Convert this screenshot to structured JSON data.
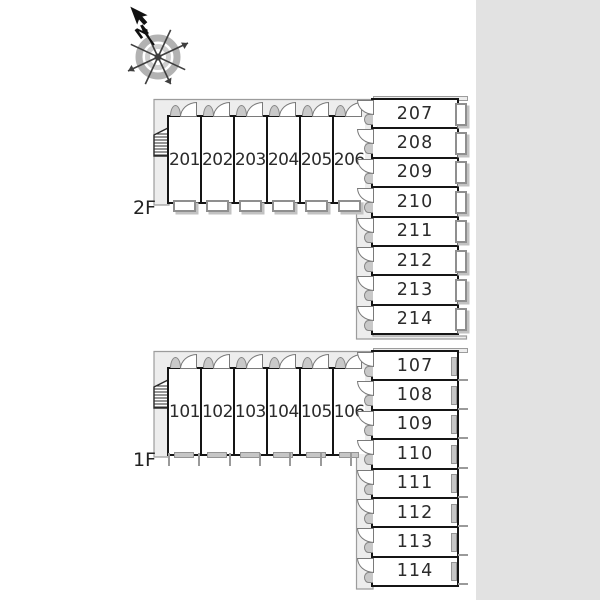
{
  "title": "apartment-unit-floor-plan",
  "compass": {
    "north_label": "N"
  },
  "floors": [
    {
      "label": "2F",
      "row_rooms": [
        "201",
        "202",
        "203",
        "204",
        "205",
        "206"
      ],
      "col_rooms": [
        "207",
        "208",
        "209",
        "210",
        "211",
        "212",
        "213",
        "214"
      ]
    },
    {
      "label": "1F",
      "row_rooms": [
        "101",
        "102",
        "103",
        "104",
        "105",
        "106"
      ],
      "col_rooms": [
        "107",
        "108",
        "109",
        "110",
        "111",
        "112",
        "113",
        "114"
      ]
    }
  ],
  "colors": {
    "wall": "#151515",
    "corridor_fill": "#ededed",
    "corridor_line": "#9c9c9c",
    "margin_band": "#e2e2e2",
    "room_fill": "#ffffff",
    "number_text": "#2b2b2b"
  }
}
